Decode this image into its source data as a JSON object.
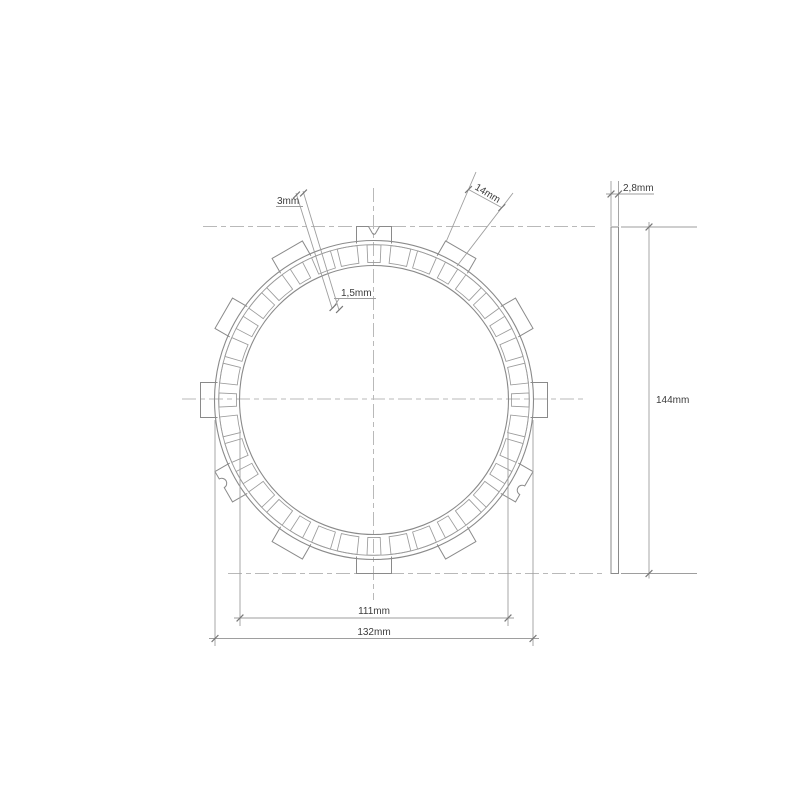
{
  "drawing": {
    "type": "technical-drawing",
    "subject": "clutch friction plate - front view and side view",
    "labels": {
      "groove_width": "3mm",
      "land_depth": "1,5mm",
      "tab_width": "14mm",
      "thickness": "2,8mm",
      "overall_diameter": "144mm",
      "inner_diameter": "111mm",
      "friction_outer_diameter": "132mm"
    },
    "values_mm": {
      "groove_width": 3,
      "land_depth": 1.5,
      "tab_width": 14,
      "thickness": 2.8,
      "overall_diameter": 144,
      "inner_diameter": 111,
      "friction_outer_diameter": 132
    },
    "geometry": {
      "tab_count": 12,
      "pad_count": 36,
      "v_notch_tab_polar_deg": 90,
      "round_notch_tab_polar_deg": [
        210,
        330
      ]
    },
    "colors": {
      "background": "#ffffff",
      "outline": "#8a8a8a",
      "thin_line": "#9b9b9b",
      "centerline": "#b9b9b9",
      "dimension_line": "#9e9e9e",
      "tick": "#787878",
      "text": "#3c3c3c"
    }
  }
}
